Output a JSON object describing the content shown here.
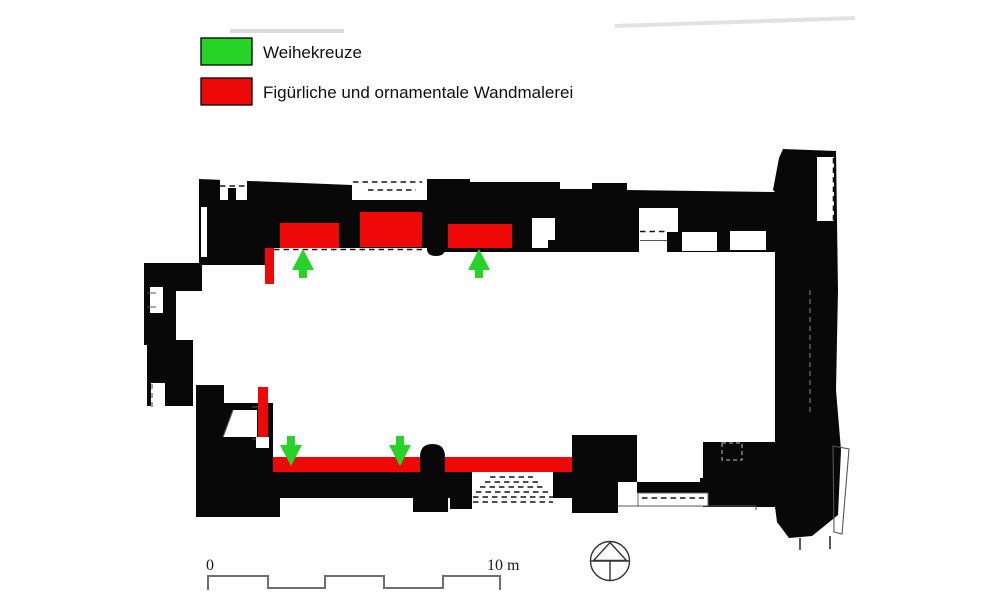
{
  "colors": {
    "wall": "#080808",
    "red": "#ee0808",
    "green": "#26d326",
    "line": "#555555"
  },
  "legend": {
    "items": [
      {
        "id": "weihekreuze",
        "label": "Weihekreuze",
        "color": "#26d326"
      },
      {
        "id": "wandmalerei",
        "label": "Figürliche und ornamentale Wandmalerei",
        "color": "#ee0808"
      }
    ]
  },
  "scale_bar": {
    "start_label": "0",
    "end_label": "10 m"
  },
  "markers": {
    "weihekreuz_arrow_count": 4,
    "arrow_directions": [
      "up",
      "up",
      "down",
      "down"
    ],
    "painting_zone_count": 7
  }
}
